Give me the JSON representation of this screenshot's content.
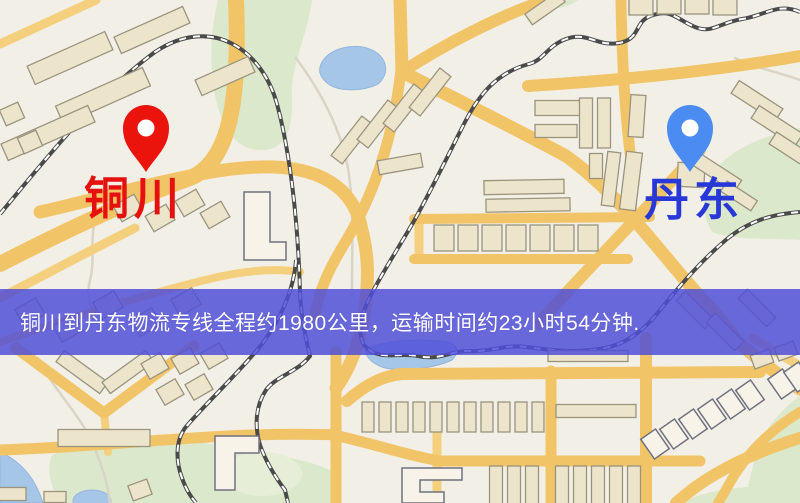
{
  "banner": {
    "text": "铜川到丹东物流专线全程约1980公里，运输时间约23小时54分钟.",
    "background_color": "#4f4ed8",
    "text_color": "#ffffff"
  },
  "origin": {
    "label": "铜川",
    "label_color": "#e6100e",
    "pin_color": "#ea140c"
  },
  "destination": {
    "label": "丹东",
    "label_color": "#2838d8",
    "pin_color": "#4a8cf2"
  },
  "map_palette": {
    "background": "#f2efe6",
    "road_major": "#f2c468",
    "road_minor": "#f4cf7d",
    "water": "#a6c6e8",
    "park": "#dce8cb",
    "railway": "#4a4a4a",
    "building": "#ece5cb"
  }
}
